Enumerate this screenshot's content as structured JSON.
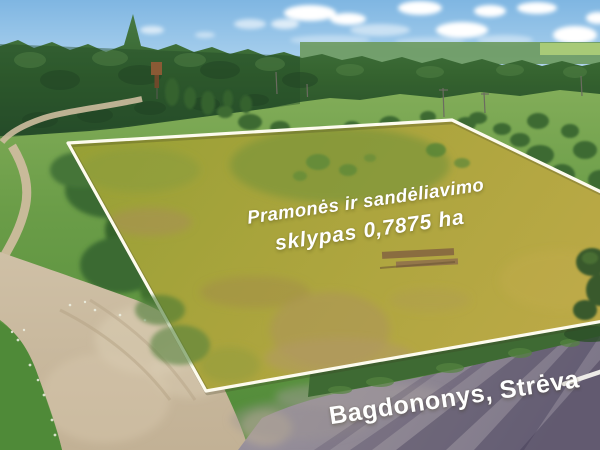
{
  "overlay": {
    "headline_line1": "Pramonės ir sandėliavimo",
    "headline_line2": "sklypas 0,7875 ha",
    "location_label": "Bagdononys, Strėva"
  },
  "scene": {
    "regions": [
      "sky",
      "clouds",
      "pine-forest",
      "far-meadow",
      "land-plot",
      "plot-boundary",
      "dirt-path",
      "gravel-road",
      "asphalt-road",
      "road-marking-dash",
      "tree-shadows",
      "shrubs",
      "water-tower",
      "utility-poles"
    ],
    "colors": {
      "text": "#ffffff",
      "boundary_line": "#fdfbee",
      "road_marking": "#f6f4ef",
      "sky": "#8fc0e6",
      "forest": "#2e5731",
      "meadow": "#699c48",
      "plot_grass": "#a8a23b",
      "gravel_road": "#c9baa0",
      "asphalt_road": "#8e8793"
    }
  }
}
